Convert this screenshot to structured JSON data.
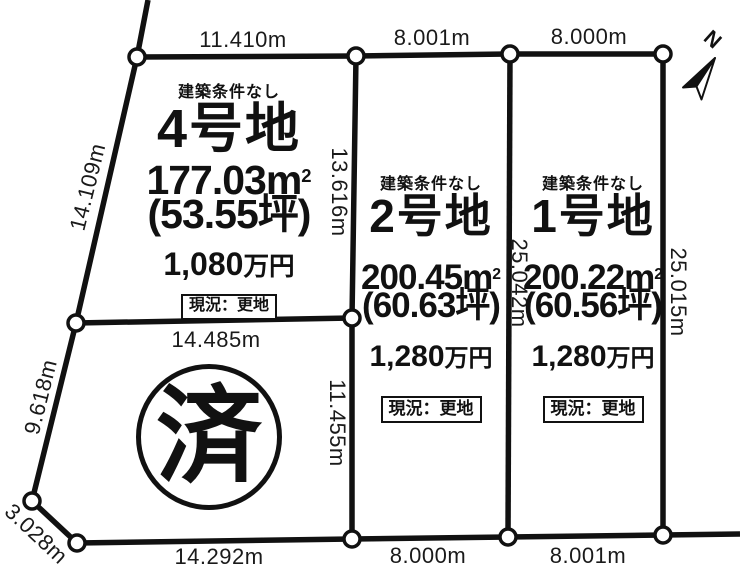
{
  "colors": {
    "line": "#111111",
    "text": "#1a1a1a",
    "background": "#ffffff"
  },
  "north": {
    "label": "N"
  },
  "dimensions": {
    "top_lot4": "11.410m",
    "top_lot2": "8.001m",
    "top_lot1": "8.000m",
    "west_upper": "14.109m",
    "west_lower": "9.618m",
    "corner_cut": "3.028m",
    "divider_sold": "14.485m",
    "mid_line_upper": "13.616m",
    "mid_line_lower": "11.455m",
    "lot2_side": "25.042m",
    "east_side": "25.015m",
    "bottom_sold": "14.292m",
    "bottom_lot2": "8.000m",
    "bottom_lot1": "8.001m"
  },
  "plots": [
    {
      "condition": "建築条件なし",
      "name": "4号地",
      "area_value": "177.03m",
      "area_sup": "2",
      "tsubo": "(53.55坪)",
      "price_value": "1,080",
      "price_unit": "万円",
      "status": "現況：更地"
    },
    {
      "condition": "建築条件なし",
      "name": "2号地",
      "area_value": "200.45m",
      "area_sup": "2",
      "tsubo": "(60.63坪)",
      "price_value": "1,280",
      "price_unit": "万円",
      "status": "現況：更地"
    },
    {
      "condition": "建築条件なし",
      "name": "1号地",
      "area_value": "200.22m",
      "area_sup": "2",
      "tsubo": "(60.56坪)",
      "price_value": "1,280",
      "price_unit": "万円",
      "status": "現況：更地"
    }
  ],
  "sold_stamp": {
    "label": "済"
  }
}
